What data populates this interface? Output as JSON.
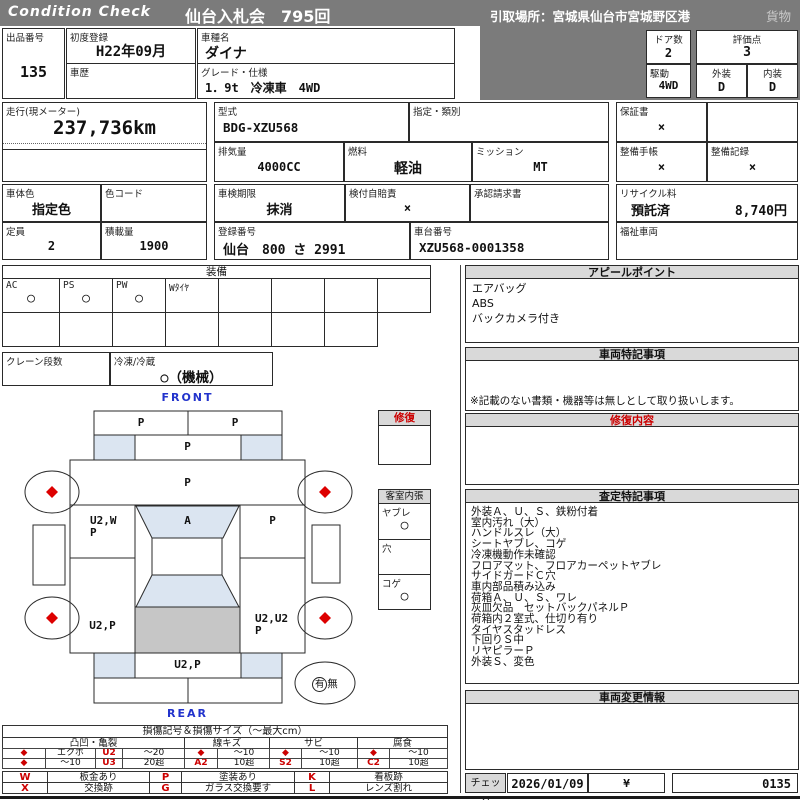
{
  "colors": {
    "header_gray": "#7b7b7b",
    "section_gray": "#d9d9d9",
    "accent_red": "#cc0000",
    "panel_blue": "#dbe5f1",
    "cargo_gray": "#c6c6c6",
    "label_blue": "#2233cc"
  },
  "header": {
    "brand": "Condition  Check",
    "auction": "仙台入札会　795回",
    "pickup": "引取場所：宮城県仙台市宮城野区港",
    "category": "貨物"
  },
  "info": {
    "lot_label": "出品番号",
    "lot": "135",
    "first_reg_label": "初度登録",
    "first_reg": "H22年09月",
    "history_label": "車歴",
    "history": "",
    "model_label": "車種名",
    "model": "ダイナ",
    "grade_label": "グレード・仕様",
    "grade": "1．9t　冷凍車　4WD",
    "doors_label": "ドア数",
    "doors": "2",
    "score_label": "評価点",
    "score": "3",
    "drive_label": "駆動",
    "drive": "4WD",
    "exterior_label": "外装",
    "exterior": "D",
    "interior_label": "内装",
    "interior": "D",
    "mileage_label": "走行(現メーター)",
    "mileage": "237,736km",
    "type_label": "型式",
    "type_code": "BDG-XZU568",
    "class_label": "指定・類別",
    "class_value": "",
    "warranty_label": "保証書",
    "warranty": "×",
    "displacement_label": "排気量",
    "displacement": "4000CC",
    "fuel_label": "燃料",
    "fuel": "軽油",
    "mission_label": "ミッション",
    "mission": "MT",
    "maintenance_book_label": "整備手帳",
    "maintenance_book": "×",
    "maintenance_record_label": "整備記録",
    "maintenance_record": "×",
    "color_label": "車体色",
    "color": "指定色",
    "color_code_label": "色コード",
    "color_code": "",
    "inspection_label": "車検期限",
    "inspection": "抹消",
    "insurance_label": "検付自賠責",
    "insurance": "×",
    "approval_label": "承認請求書",
    "approval": "",
    "recycle_label": "リサイクル料",
    "recycle_status": "預託済",
    "recycle_fee": "8,740円",
    "capacity_label": "定員",
    "capacity": "2",
    "load_label": "積載量",
    "load": "1900",
    "reg_no_label": "登録番号",
    "reg_no": "仙台　800 さ 2991",
    "chassis_label": "車台番号",
    "chassis": "XZU568-0001358",
    "welfare_label": "福祉車両",
    "welfare": ""
  },
  "equipment": {
    "title": "装備",
    "items": [
      {
        "label": "AC",
        "value": "○"
      },
      {
        "label": "PS",
        "value": "○"
      },
      {
        "label": "PW",
        "value": "○"
      },
      {
        "label": "Wﾀｲﾔ",
        "value": ""
      },
      {
        "label": "",
        "value": ""
      },
      {
        "label": "",
        "value": ""
      },
      {
        "label": "",
        "value": ""
      },
      {
        "label": "",
        "value": ""
      }
    ],
    "crane_label": "クレーン段数",
    "crane": "",
    "reefer_label": "冷凍/冷蔵",
    "reefer": "○（機械）"
  },
  "appeal": {
    "title": "アピールポイント",
    "lines": [
      "エアバッグ",
      "ABS",
      "バックカメラ付き"
    ]
  },
  "vehicle_notes": {
    "title": "車両特記事項",
    "note": "※記載のない書類・機器等は無しとして取り扱いします。"
  },
  "repair": {
    "title": "修復内容",
    "content": ""
  },
  "assessment": {
    "title": "査定特記事項",
    "lines": [
      "外装Ａ、Ｕ、Ｓ、鉄粉付着",
      "室内汚れ（大）",
      "ハンドルスレ（大）",
      "シートヤブレ、コゲ",
      "冷凍機動作未確認",
      "フロアマット、フロアカーペットヤブレ",
      "サイドガードＣ穴",
      "車内部品積み込み",
      "荷箱Ａ、Ｕ、Ｓ、ワレ",
      "灰皿欠品　セットバックパネルＰ",
      "荷箱内２室式、仕切り有り",
      "タイヤスタッドレス",
      "下回りＳ中",
      "リヤピラーＰ",
      "外装Ｓ、変色"
    ]
  },
  "change_info": {
    "title": "車両変更情報",
    "content": ""
  },
  "check": {
    "label": "チェック",
    "date": "2026/01/09",
    "yen": "¥",
    "code": "0135"
  },
  "diagram": {
    "front": "FRONT",
    "rear": "REAR",
    "panels": {
      "front_bumper_l": "P",
      "front_bumper_r": "P",
      "hood": "P",
      "windshield": "P",
      "door_left_1": "U2,W",
      "door_left_2": "P",
      "cab_glass": "A",
      "door_right": "P",
      "side_left": "U2,P",
      "side_right_1": "U2,U2",
      "side_right_2": "P",
      "rear_panel": "U2,P"
    },
    "repair_box_title": "修復",
    "cabin": {
      "title": "客室内張",
      "tear_label": "ヤブレ",
      "tear": "○",
      "hole_label": "穴",
      "hole": "",
      "burn_label": "コゲ",
      "burn": "○"
    },
    "spare_yes": "有",
    "spare_no": "無"
  },
  "legend": {
    "title": "損傷記号＆損傷サイズ（～最大cm）",
    "dent": {
      "name": "凸凹・亀裂",
      "r1": [
        "◆",
        "エクボ",
        "U2",
        "～20"
      ],
      "r2": [
        "◆",
        "～10",
        "U3",
        "20超"
      ]
    },
    "scratch": {
      "name": "線キズ",
      "r1": [
        "◆",
        "～10"
      ],
      "r2": [
        "A2",
        "10超"
      ]
    },
    "rust": {
      "name": "サビ",
      "r1": [
        "◆",
        "～10"
      ],
      "r2": [
        "S2",
        "10超"
      ]
    },
    "corrosion": {
      "name": "腐食",
      "r1": [
        "◆",
        "～10"
      ],
      "r2": [
        "C2",
        "10超"
      ]
    },
    "symbols": {
      "w": [
        "W",
        "板金あり"
      ],
      "p": [
        "P",
        "塗装あり"
      ],
      "k": [
        "K",
        "看板跡"
      ],
      "x": [
        "X",
        "交換跡"
      ],
      "g": [
        "G",
        "ガラス交換要す"
      ],
      "l": [
        "L",
        "レンズ割れ"
      ]
    }
  }
}
